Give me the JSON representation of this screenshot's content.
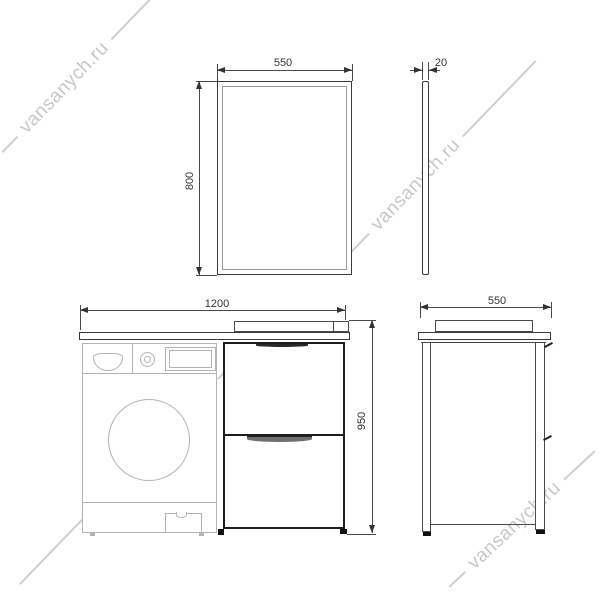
{
  "watermark": {
    "text": "vansanych.ru"
  },
  "dimensions": {
    "mirror_width": "550",
    "mirror_height": "800",
    "mirror_thickness": "20",
    "cabinet_width": "1200",
    "cabinet_height": "950",
    "cabinet_depth": "550"
  },
  "colors": {
    "line_dark": "#3a3a3a",
    "line_cabinet": "#1e1e1e",
    "line_light": "#b3b3b3",
    "watermark": "#c8c8c8",
    "dim_text": "#333333",
    "background": "#ffffff"
  }
}
